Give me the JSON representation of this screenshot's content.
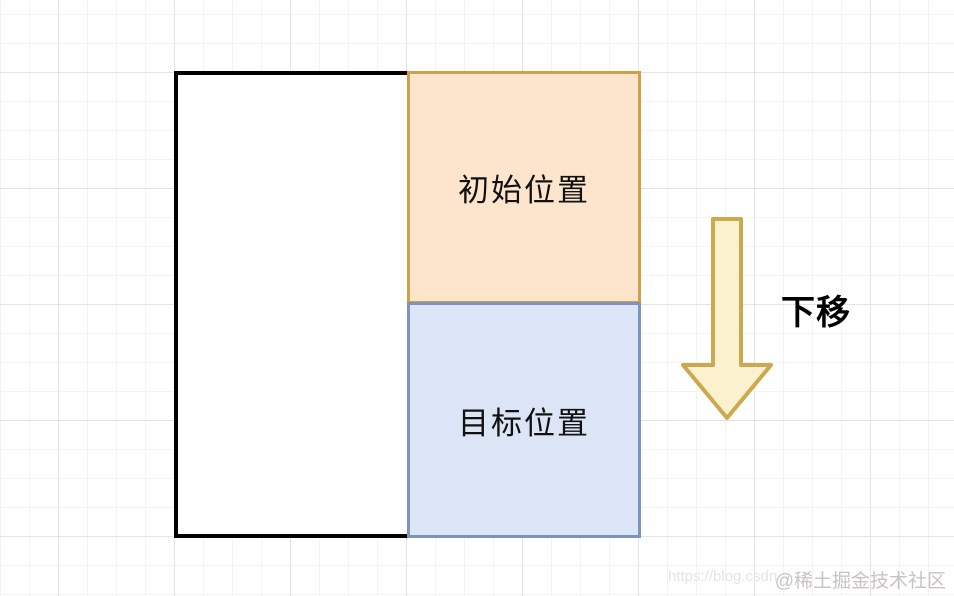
{
  "diagram": {
    "container": {
      "border_color": "#000000",
      "fill": "#ffffff"
    },
    "initial_box": {
      "label": "初始位置",
      "fill": "#fce5cc",
      "border_color": "#cfa047"
    },
    "target_box": {
      "label": "目标位置",
      "fill": "#dbe5f5",
      "border_color": "#7e93bc"
    },
    "arrow": {
      "label": "下移",
      "direction": "down",
      "fill": "#fbf1cf",
      "border_color": "#cba94e"
    }
  },
  "grid": {
    "minor_line_color": "#f3f3f3",
    "major_line_color": "#e3e3e3"
  },
  "watermark": {
    "url_text": "https://blog.csdn",
    "community_text": "@稀土掘金技术社区"
  }
}
